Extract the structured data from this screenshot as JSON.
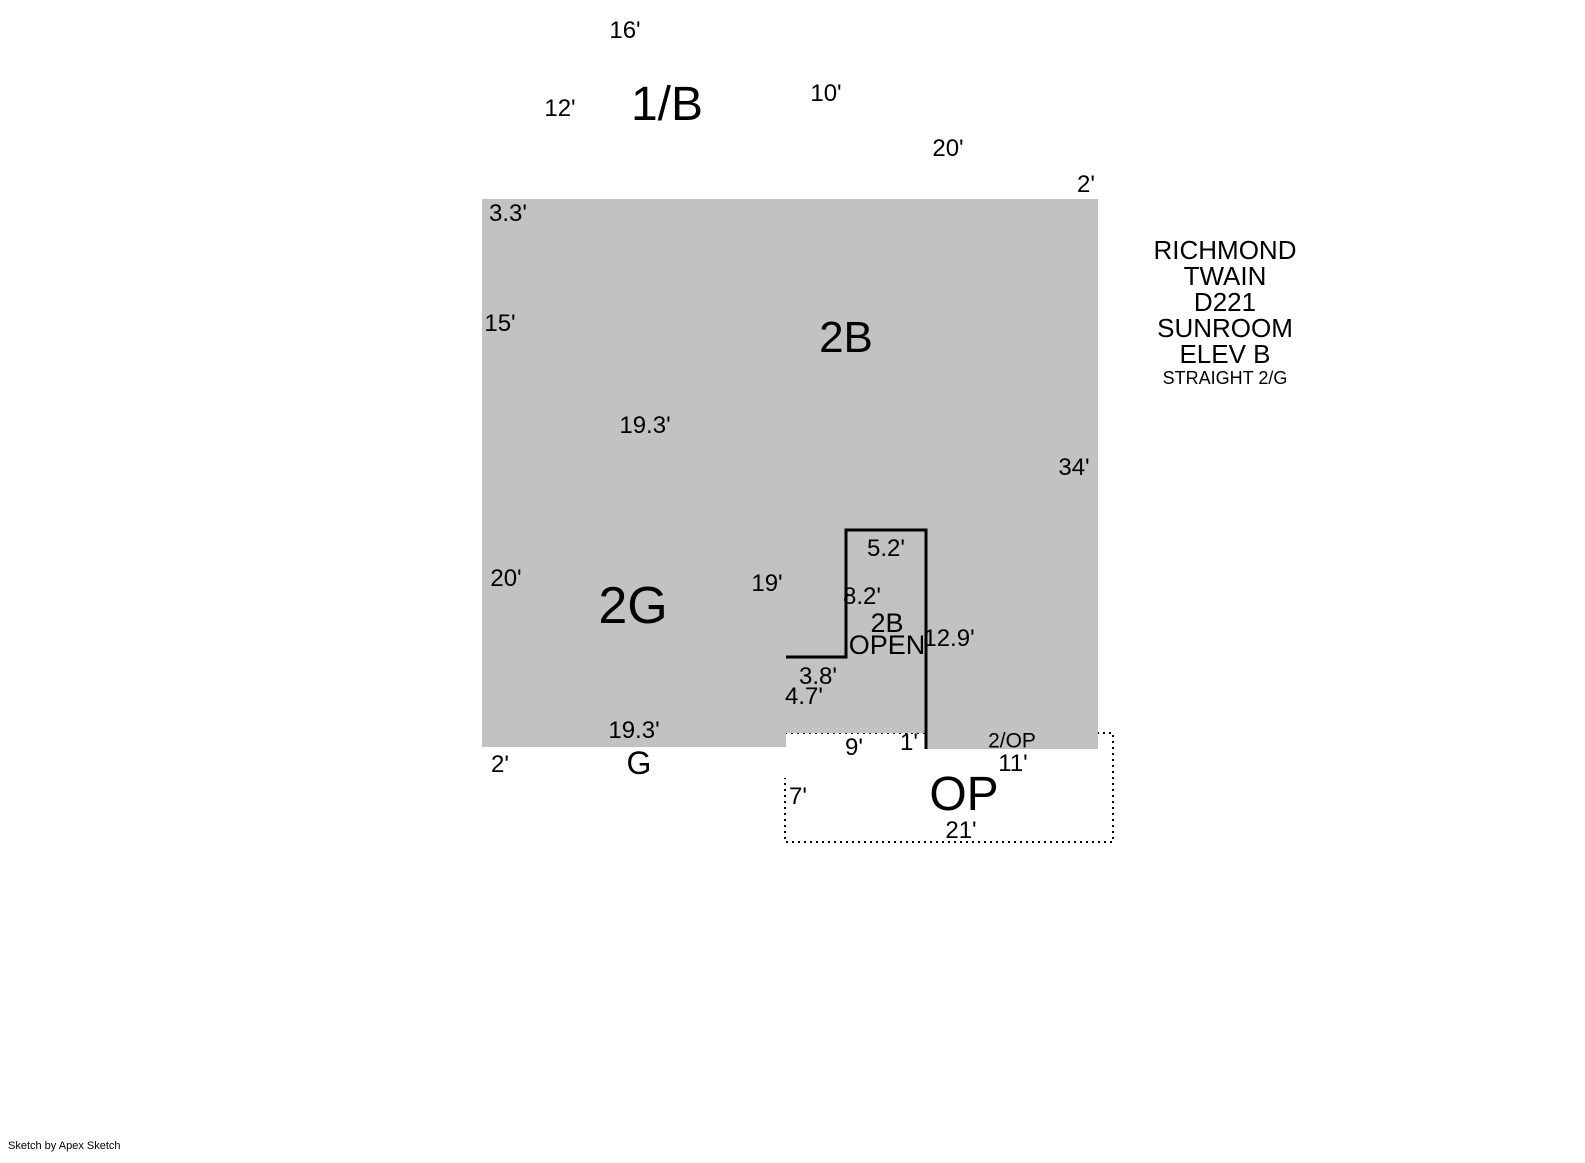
{
  "title_block": {
    "lines": [
      "RICHMOND",
      "TWAIN",
      "D221",
      "SUNROOM",
      "ELEV B"
    ],
    "subtitle": "STRAIGHT 2/G"
  },
  "footer": {
    "credit": "Sketch by Apex Sketch"
  },
  "areas": {
    "upper_level": {
      "label": "1/B"
    },
    "second_floor": {
      "label": "2B"
    },
    "garage_second": {
      "label": "2G"
    },
    "garage_strip": {
      "label": "G"
    },
    "open_area": {
      "line1": "2B",
      "line2": "OPEN"
    },
    "porch_strip": {
      "label": "2/OP"
    },
    "open_porch": {
      "label": "OP"
    }
  },
  "dimensions": {
    "top_16": "16'",
    "left_12": "12'",
    "right_10": "10'",
    "top_20": "20'",
    "right_2": "2'",
    "offset_3_3": "3.3'",
    "left_15": "15'",
    "right_34": "34'",
    "garage_top_19_3": "19.3'",
    "garage_left_20": "20'",
    "garage_right_19": "19'",
    "notch_top_5_2": "5.2'",
    "notch_left_8_2": "8.2'",
    "notch_right_12_9": "12.9'",
    "step_3_8": "3.8'",
    "step_4_7": "4.7'",
    "garage_bottom_19_3": "19.3'",
    "strip_left_2": "2'",
    "porch_9": "9'",
    "porch_1": "1'",
    "porch_11": "11'",
    "porch_left_7": "7'",
    "porch_bottom_21": "21'"
  },
  "colors": {
    "area_fill": "#c2c2c2",
    "wall": "#000000",
    "background": "#ffffff"
  }
}
